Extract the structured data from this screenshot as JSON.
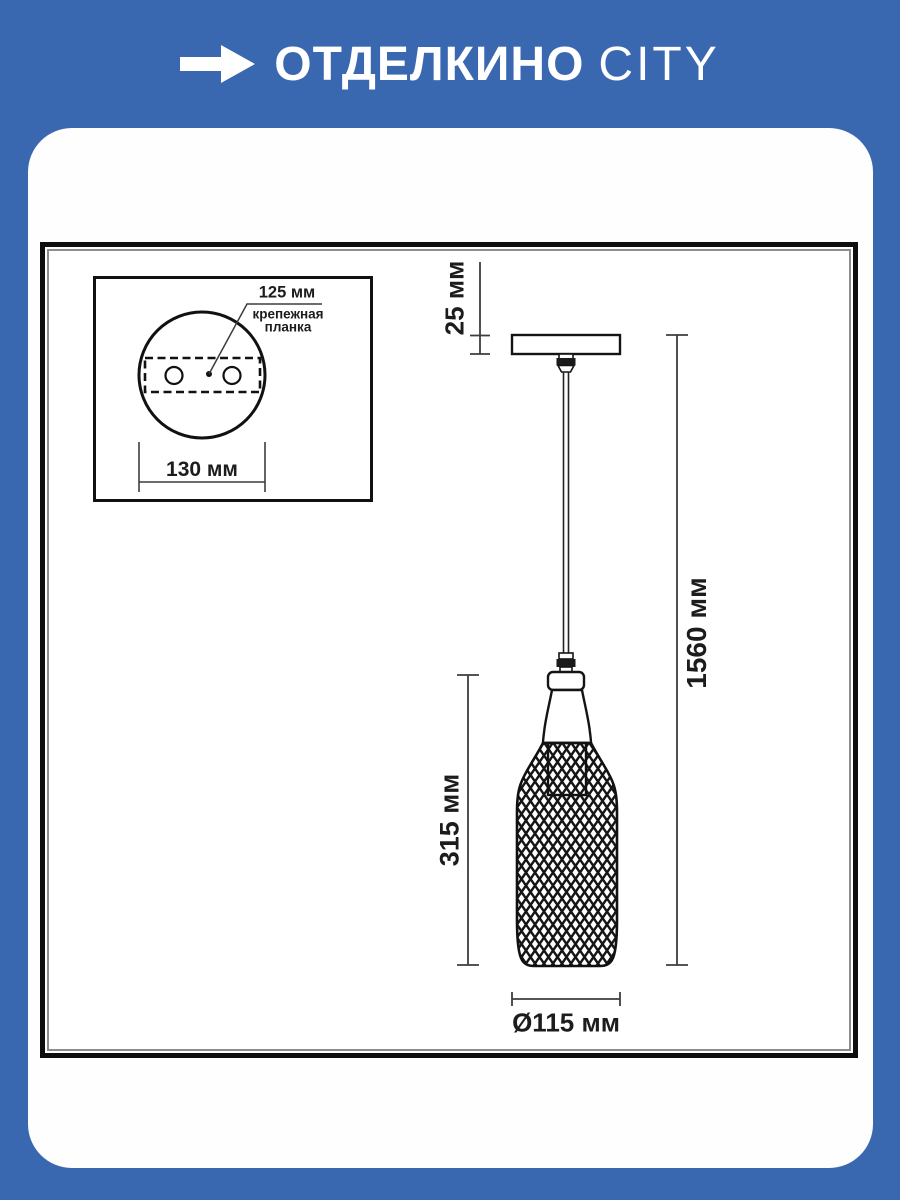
{
  "header": {
    "brand_bold": "ОТДЕЛКИНО",
    "brand_light": "CITY",
    "arrow_icon": "arrow-right-icon"
  },
  "drawing": {
    "inset": {
      "hole_pitch_label": "125 мм",
      "mount_label_line1": "крепежная",
      "mount_label_line2": "планка",
      "plate_width_label": "130 мм"
    },
    "dimensions": {
      "canopy_height": "25 мм",
      "overall_height": "1560 мм",
      "shade_height": "315 мм",
      "shade_diameter": "Ø115 мм"
    }
  },
  "colors": {
    "brand_blue": "#3a68b0",
    "ink": "#141414",
    "dim_line": "#4a4a4a"
  }
}
